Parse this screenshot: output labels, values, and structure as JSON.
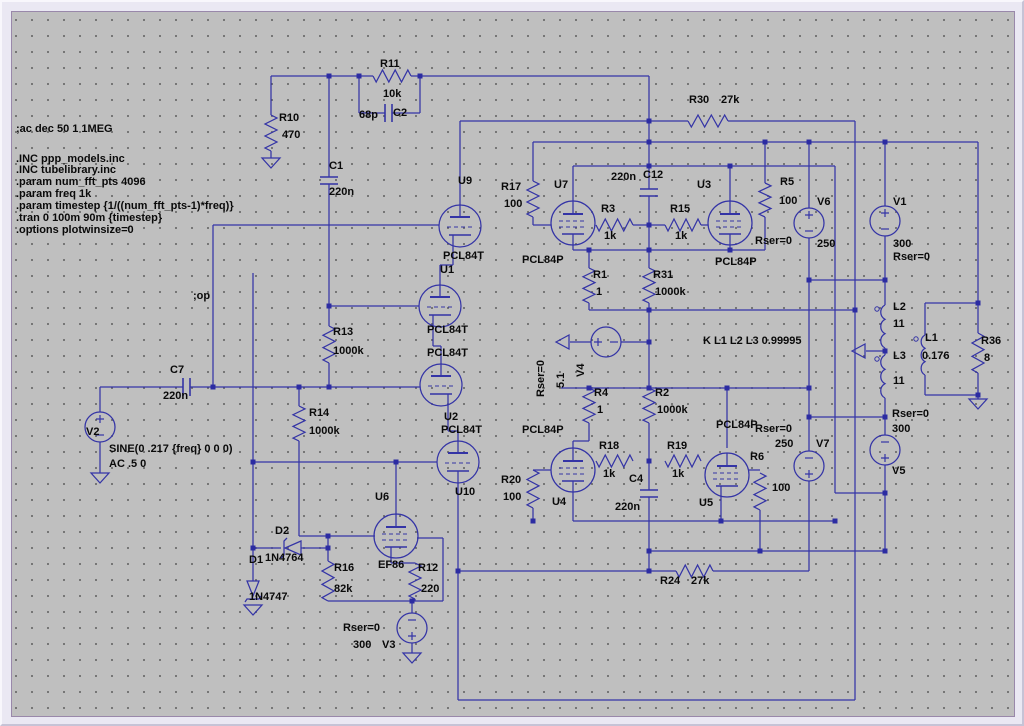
{
  "app": {
    "name": "schematic-editor",
    "canvas_bg": "#bfbfbf"
  },
  "colors": {
    "wire": "#3434a6",
    "junction": "#2c2ca2",
    "text": "#0a0a0a",
    "grid_dot": "#636363",
    "frame": "#eae8f3"
  },
  "directives": [
    {
      "id": "ac-analysis",
      "t": ";ac dec 50 1 1MEG",
      "x": 13,
      "y": 121
    },
    {
      "id": "inc-ppp-models",
      "t": ".INC ppp_models.inc",
      "x": 13,
      "y": 151
    },
    {
      "id": "inc-tubelibrary",
      "t": ".INC tubelibrary.inc",
      "x": 13,
      "y": 162
    },
    {
      "id": "param-num-fft",
      "t": ".param num_fft_pts 4096",
      "x": 13,
      "y": 174
    },
    {
      "id": "param-freq",
      "t": ".param freq 1k",
      "x": 13,
      "y": 186
    },
    {
      "id": "param-timestep",
      "t": ".param timestep {1/((num_fft_pts-1)*freq)}",
      "x": 13,
      "y": 198
    },
    {
      "id": "tran",
      "t": ".tran 0 100m 90m {timestep}",
      "x": 13,
      "y": 210
    },
    {
      "id": "options-plotwinsize",
      "t": ".options plotwinsize=0",
      "x": 13,
      "y": 222
    },
    {
      "id": "op",
      "t": ";op",
      "x": 190,
      "y": 288
    }
  ],
  "labels": [
    {
      "id": "R10",
      "t": "R10",
      "x": 276,
      "y": 110
    },
    {
      "id": "R10-val",
      "t": "470",
      "x": 279,
      "y": 127
    },
    {
      "id": "R11",
      "t": "R11",
      "x": 377,
      "y": 56
    },
    {
      "id": "R11-val",
      "t": "10k",
      "x": 380,
      "y": 86
    },
    {
      "id": "C2-val",
      "t": "68p",
      "x": 356,
      "y": 107
    },
    {
      "id": "C2",
      "t": "C2",
      "x": 390,
      "y": 105
    },
    {
      "id": "C1",
      "t": "C1",
      "x": 326,
      "y": 158
    },
    {
      "id": "C1-val",
      "t": "220n",
      "x": 326,
      "y": 184
    },
    {
      "id": "R30",
      "t": "R30",
      "x": 686,
      "y": 92
    },
    {
      "id": "R30-val",
      "t": "27k",
      "x": 718,
      "y": 92
    },
    {
      "id": "U9",
      "t": "U9",
      "x": 455,
      "y": 173
    },
    {
      "id": "U9-type",
      "t": "PCL84T",
      "x": 440,
      "y": 248
    },
    {
      "id": "R17",
      "t": "R17",
      "x": 498,
      "y": 179
    },
    {
      "id": "R17-val",
      "t": "100",
      "x": 501,
      "y": 196
    },
    {
      "id": "U7",
      "t": "U7",
      "x": 551,
      "y": 177
    },
    {
      "id": "U7-type",
      "t": "PCL84P",
      "x": 519,
      "y": 252
    },
    {
      "id": "R3",
      "t": "R3",
      "x": 598,
      "y": 201
    },
    {
      "id": "R3-val",
      "t": "1k",
      "x": 601,
      "y": 228
    },
    {
      "id": "C12-val",
      "t": "220n",
      "x": 608,
      "y": 169
    },
    {
      "id": "C12",
      "t": "C12",
      "x": 640,
      "y": 167
    },
    {
      "id": "R15",
      "t": "R15",
      "x": 667,
      "y": 201
    },
    {
      "id": "R15-val",
      "t": "1k",
      "x": 672,
      "y": 228
    },
    {
      "id": "U3",
      "t": "U3",
      "x": 694,
      "y": 177
    },
    {
      "id": "U3-type",
      "t": "PCL84P",
      "x": 712,
      "y": 254
    },
    {
      "id": "R5",
      "t": "R5",
      "x": 777,
      "y": 174
    },
    {
      "id": "R5-val",
      "t": "100",
      "x": 776,
      "y": 193
    },
    {
      "id": "V6",
      "t": "V6",
      "x": 814,
      "y": 194
    },
    {
      "id": "V6-val",
      "t": "250",
      "x": 814,
      "y": 236
    },
    {
      "id": "V6-rser",
      "t": "Rser=0",
      "x": 752,
      "y": 233
    },
    {
      "id": "V1",
      "t": "V1",
      "x": 890,
      "y": 194
    },
    {
      "id": "V1-val",
      "t": "300",
      "x": 890,
      "y": 236
    },
    {
      "id": "V1-rser",
      "t": "Rser=0",
      "x": 890,
      "y": 249
    },
    {
      "id": "R1",
      "t": "R1",
      "x": 590,
      "y": 267
    },
    {
      "id": "R1-val",
      "t": "1",
      "x": 593,
      "y": 284
    },
    {
      "id": "R31",
      "t": "R31",
      "x": 650,
      "y": 267
    },
    {
      "id": "R31-val",
      "t": "1000k",
      "x": 652,
      "y": 284
    },
    {
      "id": "R13",
      "t": "R13",
      "x": 330,
      "y": 324
    },
    {
      "id": "R13-val",
      "t": "1000k",
      "x": 330,
      "y": 343
    },
    {
      "id": "U1",
      "t": "U1",
      "x": 437,
      "y": 262
    },
    {
      "id": "U1-type",
      "t": "PCL84T",
      "x": 424,
      "y": 322
    },
    {
      "id": "U2-type",
      "t": "PCL84T",
      "x": 424,
      "y": 345
    },
    {
      "id": "U2",
      "t": "U2",
      "x": 441,
      "y": 409
    },
    {
      "id": "U10-type",
      "t": "PCL84T",
      "x": 438,
      "y": 422
    },
    {
      "id": "U10",
      "t": "U10",
      "x": 452,
      "y": 484
    },
    {
      "id": "K-stmt",
      "t": "K L1 L2 L3 0.99995",
      "x": 700,
      "y": 333
    },
    {
      "id": "V4-rser",
      "t": "Rser=0",
      "x": 533,
      "y": 394,
      "r": 1
    },
    {
      "id": "V4-val",
      "t": "5.1",
      "x": 553,
      "y": 385,
      "r": 1
    },
    {
      "id": "V4",
      "t": "V4",
      "x": 573,
      "y": 374,
      "r": 1
    },
    {
      "id": "C7",
      "t": "C7",
      "x": 167,
      "y": 362
    },
    {
      "id": "C7-val",
      "t": "220n",
      "x": 160,
      "y": 388
    },
    {
      "id": "V2",
      "t": "V2",
      "x": 83,
      "y": 424
    },
    {
      "id": "V2-sine",
      "t": "SINE(0 .217 {freq} 0 0 0)",
      "x": 106,
      "y": 441
    },
    {
      "id": "V2-ac",
      "t": "AC .5 0",
      "x": 106,
      "y": 456
    },
    {
      "id": "R14",
      "t": "R14",
      "x": 306,
      "y": 405
    },
    {
      "id": "R14-val",
      "t": "1000k",
      "x": 306,
      "y": 423
    },
    {
      "id": "R4",
      "t": "R4",
      "x": 591,
      "y": 385
    },
    {
      "id": "R4-val",
      "t": "1",
      "x": 594,
      "y": 402
    },
    {
      "id": "R2",
      "t": "R2",
      "x": 652,
      "y": 385
    },
    {
      "id": "R2-val",
      "t": "1000k",
      "x": 654,
      "y": 402
    },
    {
      "id": "U4-type",
      "t": "PCL84P",
      "x": 519,
      "y": 422
    },
    {
      "id": "U5-type",
      "t": "PCL84P",
      "x": 713,
      "y": 417
    },
    {
      "id": "V7-rser",
      "t": "Rser=0",
      "x": 752,
      "y": 421
    },
    {
      "id": "V7-val",
      "t": "250",
      "x": 772,
      "y": 436
    },
    {
      "id": "V7",
      "t": "V7",
      "x": 813,
      "y": 436
    },
    {
      "id": "R18",
      "t": "R18",
      "x": 596,
      "y": 438
    },
    {
      "id": "R18-val",
      "t": "1k",
      "x": 600,
      "y": 466
    },
    {
      "id": "C4",
      "t": "C4",
      "x": 626,
      "y": 471
    },
    {
      "id": "C4-val",
      "t": "220n",
      "x": 612,
      "y": 499
    },
    {
      "id": "R19",
      "t": "R19",
      "x": 664,
      "y": 438
    },
    {
      "id": "R19-val",
      "t": "1k",
      "x": 669,
      "y": 466
    },
    {
      "id": "R6",
      "t": "R6",
      "x": 747,
      "y": 449
    },
    {
      "id": "R6-val",
      "t": "100",
      "x": 769,
      "y": 480
    },
    {
      "id": "R20",
      "t": "R20",
      "x": 498,
      "y": 472
    },
    {
      "id": "R20-val",
      "t": "100",
      "x": 500,
      "y": 489
    },
    {
      "id": "U4",
      "t": "U4",
      "x": 549,
      "y": 494
    },
    {
      "id": "U5",
      "t": "U5",
      "x": 696,
      "y": 495
    },
    {
      "id": "V5-rser",
      "t": "Rser=0",
      "x": 889,
      "y": 406
    },
    {
      "id": "V5-val",
      "t": "300",
      "x": 889,
      "y": 421
    },
    {
      "id": "V5",
      "t": "V5",
      "x": 889,
      "y": 463
    },
    {
      "id": "L2",
      "t": "L2",
      "x": 890,
      "y": 299
    },
    {
      "id": "L2-val",
      "t": "11",
      "x": 890,
      "y": 316
    },
    {
      "id": "L3",
      "t": "L3",
      "x": 890,
      "y": 348
    },
    {
      "id": "L3-val",
      "t": "11",
      "x": 890,
      "y": 373
    },
    {
      "id": "L1",
      "t": "L1",
      "x": 922,
      "y": 330
    },
    {
      "id": "L1-val",
      "t": "0.176",
      "x": 919,
      "y": 348
    },
    {
      "id": "R36",
      "t": "R36",
      "x": 978,
      "y": 333
    },
    {
      "id": "R36-val",
      "t": "8",
      "x": 981,
      "y": 350
    },
    {
      "id": "D2",
      "t": "D2",
      "x": 272,
      "y": 523
    },
    {
      "id": "D1",
      "t": "D1",
      "x": 246,
      "y": 552
    },
    {
      "id": "D2-val",
      "t": "1N4764",
      "x": 262,
      "y": 550
    },
    {
      "id": "D1-val",
      "t": "1N4747",
      "x": 246,
      "y": 589
    },
    {
      "id": "R16",
      "t": "R16",
      "x": 331,
      "y": 560
    },
    {
      "id": "R16-val",
      "t": "82k",
      "x": 331,
      "y": 581
    },
    {
      "id": "U6",
      "t": "U6",
      "x": 372,
      "y": 489
    },
    {
      "id": "U6-type",
      "t": "EF86",
      "x": 375,
      "y": 557
    },
    {
      "id": "R12",
      "t": "R12",
      "x": 415,
      "y": 560
    },
    {
      "id": "R12-val",
      "t": "220",
      "x": 418,
      "y": 581
    },
    {
      "id": "V3-rser",
      "t": "Rser=0",
      "x": 340,
      "y": 620
    },
    {
      "id": "V3-val",
      "t": "300",
      "x": 350,
      "y": 637
    },
    {
      "id": "V3",
      "t": "V3",
      "x": 379,
      "y": 637
    },
    {
      "id": "R24",
      "t": "R24",
      "x": 657,
      "y": 573
    },
    {
      "id": "R24-val",
      "t": "27k",
      "x": 688,
      "y": 573
    }
  ]
}
